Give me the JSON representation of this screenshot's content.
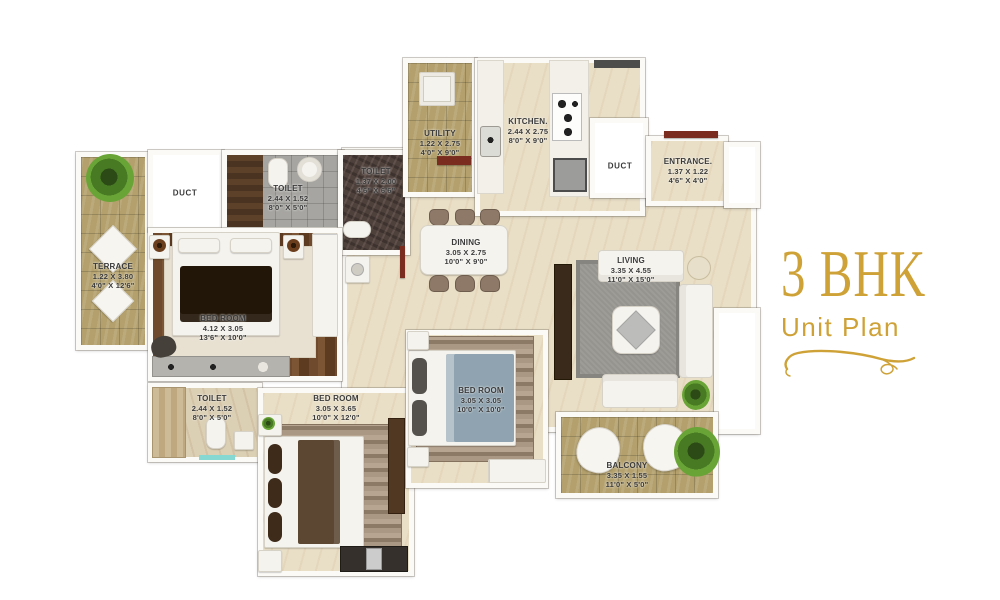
{
  "title": {
    "main": "3 BHK",
    "sub": "Unit Plan"
  },
  "accent_color": "#CFA238",
  "rooms": [
    {
      "id": "terrace",
      "name": "TERRACE",
      "dim_m": "1.22 X 3.80",
      "dim_ft": "4'0\" X 12'6\""
    },
    {
      "id": "duct-left",
      "name": "DUCT"
    },
    {
      "id": "toilet-master",
      "name": "TOILET",
      "dim_m": "2.44 X 1.52",
      "dim_ft": "8'0\" X 5'0\""
    },
    {
      "id": "toilet-common-upper",
      "name": "TOILET",
      "dim_m": "1.37 X 2.00",
      "dim_ft": "4'6\" X 6'6\""
    },
    {
      "id": "utility",
      "name": "UTILITY",
      "dim_m": "1.22 X 2.75",
      "dim_ft": "4'0\" X 9'0\""
    },
    {
      "id": "kitchen",
      "name": "KITCHEN.",
      "dim_m": "2.44 X 2.75",
      "dim_ft": "8'0\" X 9'0\""
    },
    {
      "id": "duct-right",
      "name": "DUCT"
    },
    {
      "id": "entrance",
      "name": "ENTRANCE.",
      "dim_m": "1.37 X 1.22",
      "dim_ft": "4'6\" X 4'0\""
    },
    {
      "id": "dining",
      "name": "DINING",
      "dim_m": "3.05 X 2.75",
      "dim_ft": "10'0\" X 9'0\""
    },
    {
      "id": "living",
      "name": "LIVING",
      "dim_m": "3.35 X 4.55",
      "dim_ft": "11'0\" X 15'0\""
    },
    {
      "id": "bedroom-master",
      "name": "BED ROOM",
      "dim_m": "4.12 X 3.05",
      "dim_ft": "13'6\" X 10'0\""
    },
    {
      "id": "bedroom-middle",
      "name": "BED ROOM",
      "dim_m": "3.05 X 3.05",
      "dim_ft": "10'0\" X 10'0\""
    },
    {
      "id": "bedroom-lower",
      "name": "BED ROOM",
      "dim_m": "3.05 X 3.65",
      "dim_ft": "10'0\" X 12'0\""
    },
    {
      "id": "toilet-lower",
      "name": "TOILET",
      "dim_m": "2.44 X 1.52",
      "dim_ft": "8'0\" X 5'0\""
    },
    {
      "id": "balcony",
      "name": "BALCONY",
      "dim_m": "3.35 X 1.55",
      "dim_ft": "11'0\" X 5'0\""
    }
  ]
}
